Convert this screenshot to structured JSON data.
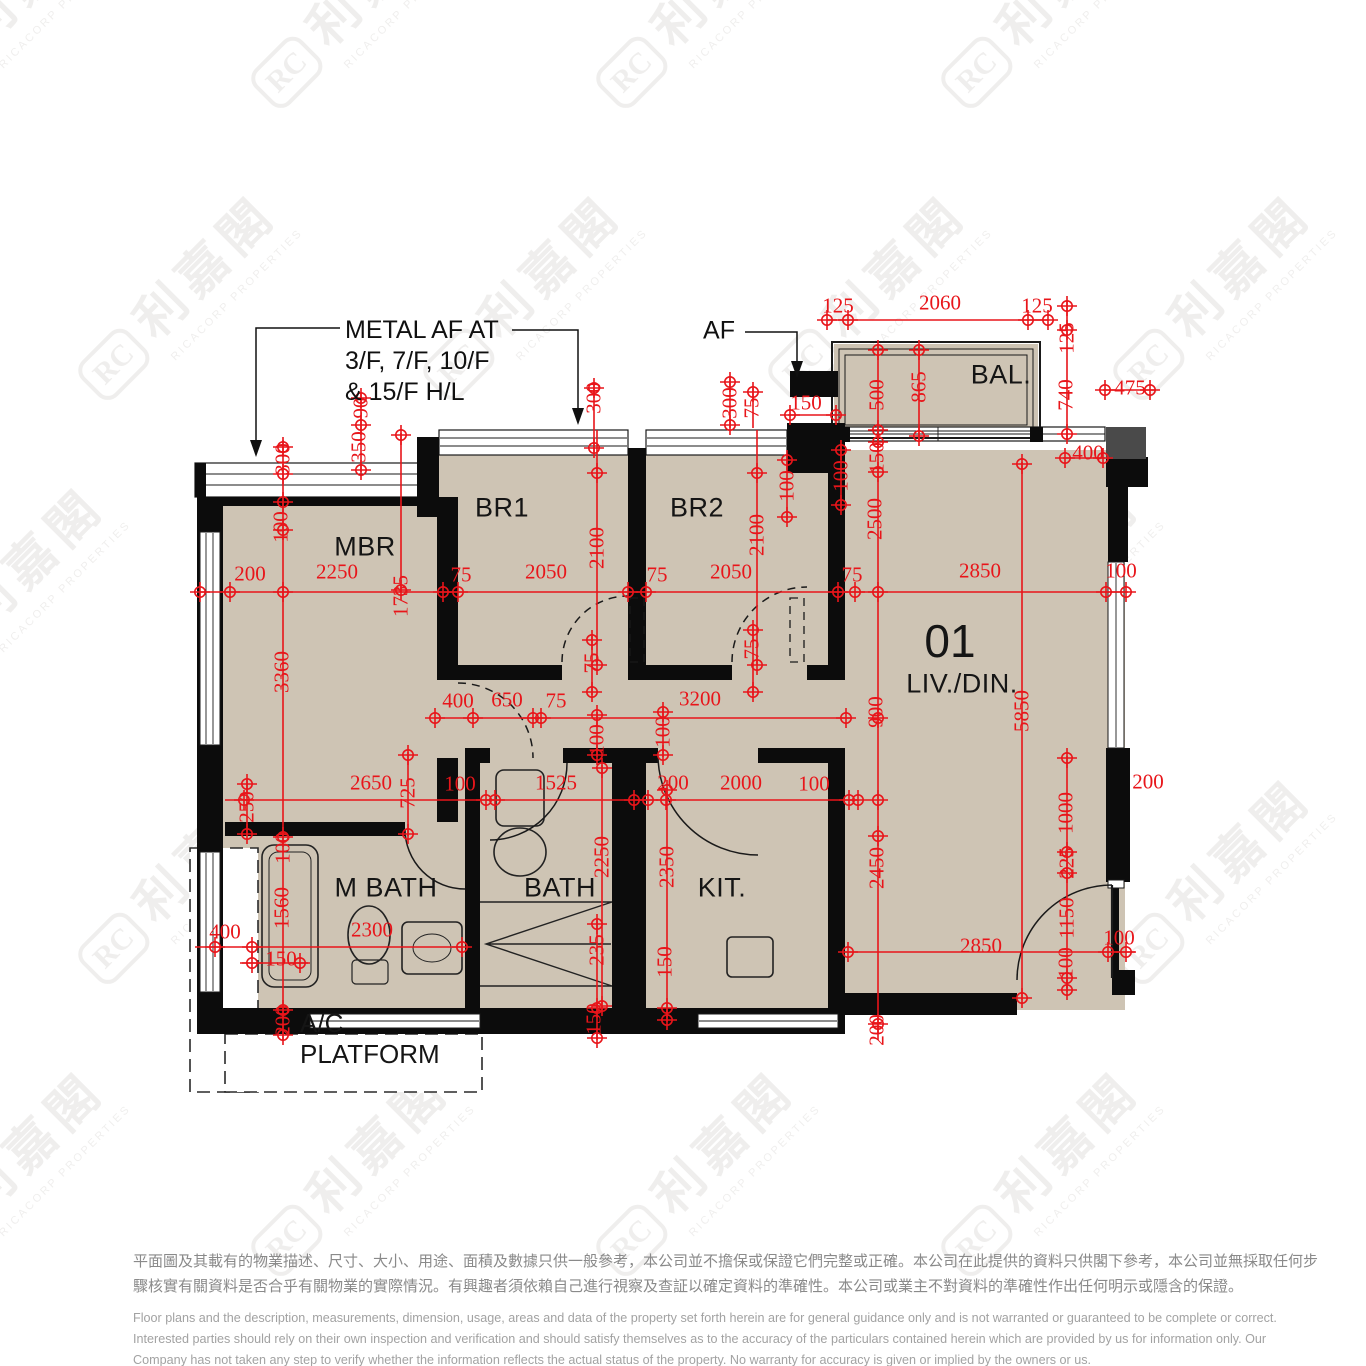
{
  "rooms": {
    "mbr": "MBR",
    "br1": "BR1",
    "br2": "BR2",
    "bal": "BAL.",
    "unit_number": "01",
    "livdin": "LIV./DIN.",
    "mbath": "M BATH",
    "bath": "BATH",
    "kit": "KIT.",
    "ac_line1": "A/C",
    "ac_line2": "PLATFORM"
  },
  "notes": {
    "metal_af_line1": "METAL AF AT",
    "metal_af_line2": "3/F, 7/F, 10/F",
    "metal_af_line3": "& 15/F H/L",
    "af": "AF"
  },
  "watermark": {
    "logo": "RC",
    "cjk": "利嘉閣",
    "latin": "RICACORP PROPERTIES"
  },
  "colors": {
    "dimension_red": "#e8151a",
    "wall_black": "#0c0c0c",
    "floor_tan": "#cec4b4"
  },
  "disclaimer": {
    "zh_line1": "平面圖及其載有的物業描述、尺寸、大小、用途、面積及數據只供一般參考，本公司並不擔保或保證它們完整或正確。本公司在此提供的資料只供閣下參考，本公司並無採取任何步",
    "zh_line2": "驟核實有關資料是否合乎有關物業的實際情況。有興趣者須依賴自己進行視察及查証以確定資料的準確性。本公司或業主不對資料的準確性作出任何明示或隱含的保證。",
    "en_line1": "Floor plans and the description, measurements, dimension, usage, areas and data of the property set forth herein are for general guidance only and is not warranted or guaranteed to be complete or correct.",
    "en_line2": "Interested parties should rely on their own inspection and verification and should satisfy themselves as to the accuracy of the particulars contained herein which are provided by us for information only.  Our",
    "en_line3": "Company has not taken any step to verify whether the information reflects the actual status of the property.  No warranty for accuracy is given or implied by the owners or us."
  },
  "dimensions": [
    {
      "t": "125",
      "x": 838,
      "y": 306
    },
    {
      "t": "2060",
      "x": 940,
      "y": 303
    },
    {
      "t": "125",
      "x": 1037,
      "y": 306
    },
    {
      "t": "475",
      "x": 1130,
      "y": 388
    },
    {
      "t": "400",
      "x": 1088,
      "y": 453
    },
    {
      "t": "150",
      "x": 806,
      "y": 403
    },
    {
      "t": "200",
      "x": 250,
      "y": 574
    },
    {
      "t": "2250",
      "x": 337,
      "y": 572
    },
    {
      "t": "75",
      "x": 461,
      "y": 575
    },
    {
      "t": "2050",
      "x": 546,
      "y": 572
    },
    {
      "t": "75",
      "x": 657,
      "y": 575
    },
    {
      "t": "2050",
      "x": 731,
      "y": 572
    },
    {
      "t": "75",
      "x": 852,
      "y": 575
    },
    {
      "t": "2850",
      "x": 980,
      "y": 571
    },
    {
      "t": "100",
      "x": 1121,
      "y": 571
    },
    {
      "t": "400",
      "x": 458,
      "y": 701
    },
    {
      "t": "650",
      "x": 507,
      "y": 700
    },
    {
      "t": "75",
      "x": 556,
      "y": 701
    },
    {
      "t": "3200",
      "x": 700,
      "y": 699
    },
    {
      "t": "2650",
      "x": 371,
      "y": 783
    },
    {
      "t": "100",
      "x": 460,
      "y": 784
    },
    {
      "t": "1525",
      "x": 556,
      "y": 783
    },
    {
      "t": "200",
      "x": 673,
      "y": 783
    },
    {
      "t": "2000",
      "x": 741,
      "y": 783
    },
    {
      "t": "100",
      "x": 814,
      "y": 784
    },
    {
      "t": "400",
      "x": 225,
      "y": 932
    },
    {
      "t": "2300",
      "x": 372,
      "y": 930
    },
    {
      "t": "150",
      "x": 281,
      "y": 959
    },
    {
      "t": "2850",
      "x": 981,
      "y": 946
    },
    {
      "t": "100",
      "x": 1119,
      "y": 938
    },
    {
      "t": "200",
      "x": 1148,
      "y": 782
    },
    {
      "t": "300",
      "x": 283,
      "y": 459,
      "v": 1
    },
    {
      "t": "100",
      "x": 281,
      "y": 527,
      "v": 1
    },
    {
      "t": "3360",
      "x": 282,
      "y": 672,
      "v": 1
    },
    {
      "t": "90",
      "x": 361,
      "y": 408,
      "v": 1
    },
    {
      "t": "350",
      "x": 359,
      "y": 447,
      "v": 1
    },
    {
      "t": "300",
      "x": 594,
      "y": 398,
      "v": 1
    },
    {
      "t": "1735",
      "x": 401,
      "y": 596,
      "v": 1
    },
    {
      "t": "2100",
      "x": 597,
      "y": 548,
      "v": 1
    },
    {
      "t": "2100",
      "x": 757,
      "y": 535,
      "v": 1
    },
    {
      "t": "300",
      "x": 730,
      "y": 403,
      "v": 1
    },
    {
      "t": "75",
      "x": 752,
      "y": 408,
      "v": 1
    },
    {
      "t": "100",
      "x": 787,
      "y": 486,
      "v": 1
    },
    {
      "t": "100",
      "x": 841,
      "y": 476,
      "v": 1
    },
    {
      "t": "150",
      "x": 877,
      "y": 458,
      "v": 1
    },
    {
      "t": "500",
      "x": 877,
      "y": 395,
      "v": 1
    },
    {
      "t": "865",
      "x": 919,
      "y": 387,
      "v": 1
    },
    {
      "t": "125",
      "x": 1067,
      "y": 338,
      "v": 1
    },
    {
      "t": "740",
      "x": 1066,
      "y": 395,
      "v": 1
    },
    {
      "t": "2500",
      "x": 875,
      "y": 519,
      "v": 1
    },
    {
      "t": "900",
      "x": 876,
      "y": 712,
      "v": 1
    },
    {
      "t": "5850",
      "x": 1022,
      "y": 711,
      "v": 1
    },
    {
      "t": "2450",
      "x": 877,
      "y": 868,
      "v": 1
    },
    {
      "t": "200",
      "x": 877,
      "y": 1030,
      "v": 1
    },
    {
      "t": "1000",
      "x": 1066,
      "y": 813,
      "v": 1
    },
    {
      "t": "225",
      "x": 1067,
      "y": 863,
      "v": 1
    },
    {
      "t": "1150",
      "x": 1067,
      "y": 918,
      "v": 1
    },
    {
      "t": "100",
      "x": 1066,
      "y": 963,
      "v": 1
    },
    {
      "t": "75",
      "x": 592,
      "y": 663,
      "v": 1
    },
    {
      "t": "75",
      "x": 752,
      "y": 649,
      "v": 1
    },
    {
      "t": "100",
      "x": 597,
      "y": 740,
      "v": 1
    },
    {
      "t": "100",
      "x": 663,
      "y": 732,
      "v": 1
    },
    {
      "t": "250",
      "x": 247,
      "y": 807,
      "v": 1
    },
    {
      "t": "100",
      "x": 283,
      "y": 848,
      "v": 1
    },
    {
      "t": "1560",
      "x": 282,
      "y": 908,
      "v": 1
    },
    {
      "t": "200",
      "x": 283,
      "y": 1021,
      "v": 1
    },
    {
      "t": "725",
      "x": 408,
      "y": 793,
      "v": 1
    },
    {
      "t": "2250",
      "x": 602,
      "y": 857,
      "v": 1
    },
    {
      "t": "235",
      "x": 597,
      "y": 950,
      "v": 1
    },
    {
      "t": "150",
      "x": 594,
      "y": 1019,
      "v": 1
    },
    {
      "t": "2350",
      "x": 667,
      "y": 867,
      "v": 1
    },
    {
      "t": "150",
      "x": 665,
      "y": 962,
      "v": 1
    }
  ]
}
